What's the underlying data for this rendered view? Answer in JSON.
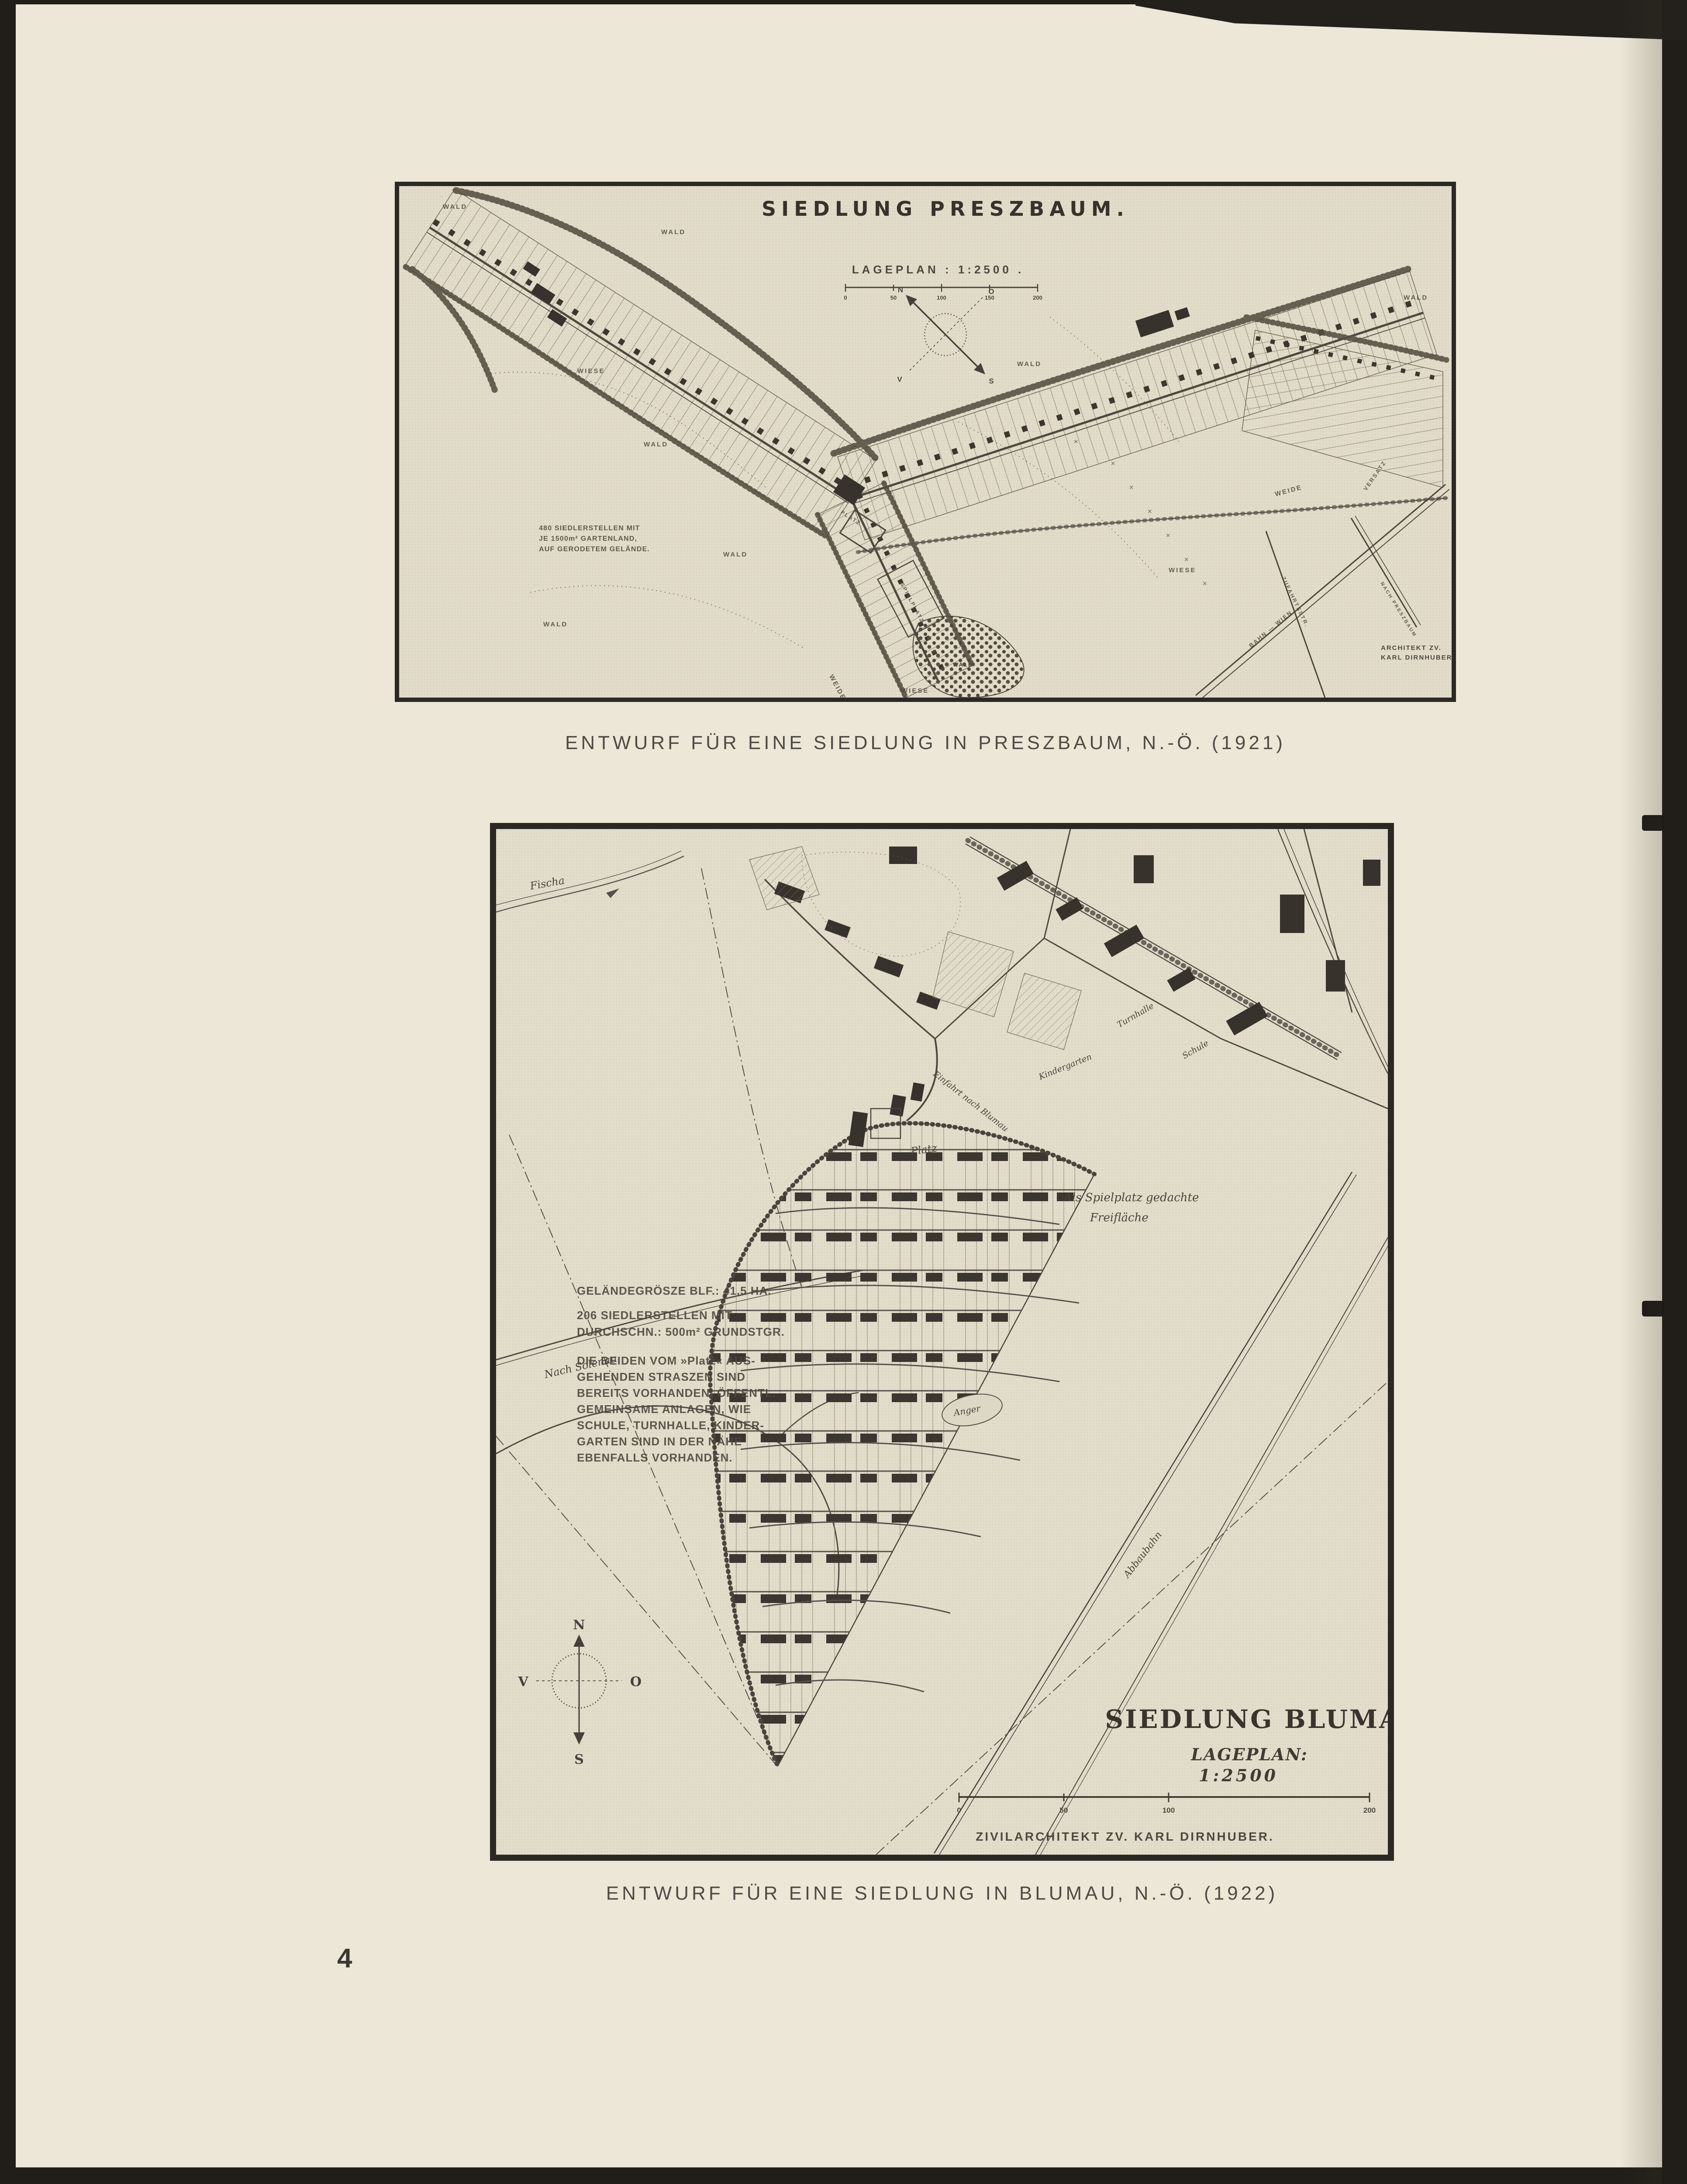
{
  "page": {
    "number": "4",
    "colors": {
      "surround": "#211e19",
      "paper": "#ece7d6",
      "map_paper": "#e1dcc9",
      "ink": "#45403a"
    }
  },
  "preszbaum": {
    "map_title": "SIEDLUNG PRESZBAUM.",
    "scale_heading": "LAGEPLAN : 1:2500 .",
    "scale_ticks": [
      "0",
      "50",
      "100",
      "150",
      "200"
    ],
    "notes_lines": [
      "480 SIEDLERSTELLEN MIT",
      "JE 1500m² GARTENLAND,",
      "AUF GERODETEM GELÄNDE."
    ],
    "architect_lines": [
      "ARCHITEKT ZV.",
      "KARL DIRNHUBER."
    ],
    "labels": {
      "wald": "WALD",
      "wiese": "WIESE",
      "weide": "WEIDE",
      "versatz": "VERSATZ",
      "zufahrtsstrasse": "ZUFAHRTSSTR.",
      "bahn_wien": "BAHN — WIEN",
      "nach_preszbaum": "NACH PRESZBAUM",
      "platz": "PLATZ",
      "spielplatz": "SPIELPLATZ",
      "x_mark": "×"
    },
    "compass": {
      "n": "N",
      "o": "O",
      "w": "V",
      "s": "S"
    },
    "caption": "ENTWURF FÜR EINE SIEDLUNG IN PRESZBAUM, N.-Ö. (1921)"
  },
  "blumau": {
    "map_title": "SIEDLUNG BLUMAU",
    "scale_heading_line1": "LAGEPLAN:",
    "scale_heading_line2": "1:2500",
    "scale_ticks": [
      "0",
      "50",
      "100",
      "200"
    ],
    "architect": "ZIVILARCHITEKT ZV. KARL DIRNHUBER.",
    "notes_lines": [
      "GELÄNDEGRÖSZE BLF.: 41,5 HA.",
      "206 SIEDLERSTELLEN MIT",
      "DURCHSCHN.: 500m² GRUNDSTGR.",
      "DIE BEIDEN VOM »Platz« AUS-",
      "GEHENDEN STRASZEN SIND",
      "BEREITS VORHANDEN. ÖFFENTL.",
      "GEMEINSAME ANLAGEN, WIE",
      "SCHULE, TURNHALLE, KINDER-",
      "GARTEN SIND IN DER NÄHE",
      "EBENFALLS VORHANDEN."
    ],
    "labels": {
      "fischa": "Fischa",
      "nach_solenau": "Nach Solenau",
      "platz": "Platz",
      "anger": "Anger",
      "einfahrt": "Einfahrt nach Blumau",
      "spielplatz_line1": "Als Spielplatz gedachte",
      "spielplatz_line2": "Freifläche",
      "abbaubahn": "Abbaubahn",
      "schule": "Schule",
      "turnhalle": "Turnhalle",
      "kindergarten": "Kindergarten"
    },
    "compass": {
      "n": "N",
      "o": "O",
      "w": "V",
      "s": "S"
    },
    "caption": "ENTWURF FÜR EINE SIEDLUNG IN BLUMAU, N.-Ö. (1922)"
  }
}
